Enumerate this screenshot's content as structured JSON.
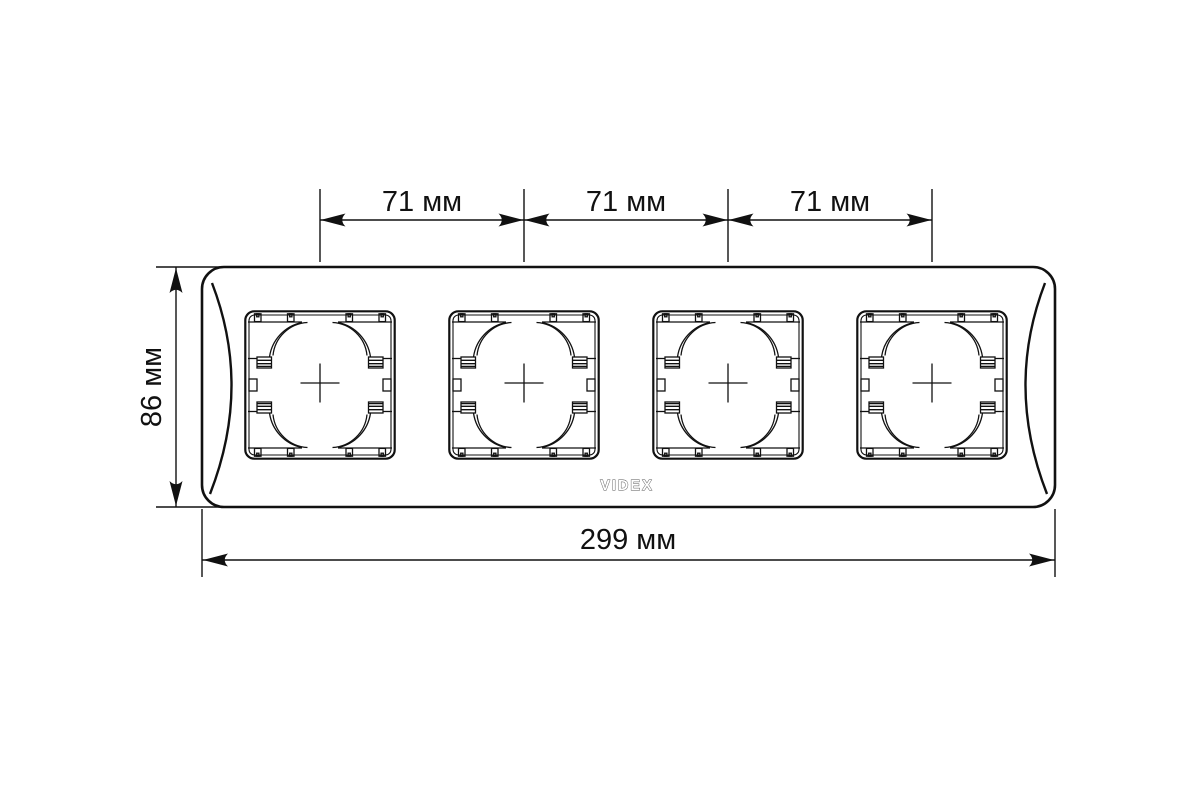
{
  "canvas": {
    "background": "#ffffff",
    "line_color": "#111111"
  },
  "drawing": {
    "type": "technical-dimension-drawing",
    "brand_label": "VIDEX",
    "units": "мм",
    "socket_openings_count": 4,
    "top_dimensions": {
      "labels": [
        "71 мм",
        "71 мм",
        "71 мм"
      ]
    },
    "height_dimension": {
      "label": "86 мм"
    },
    "width_dimension": {
      "label": "299 мм"
    }
  }
}
